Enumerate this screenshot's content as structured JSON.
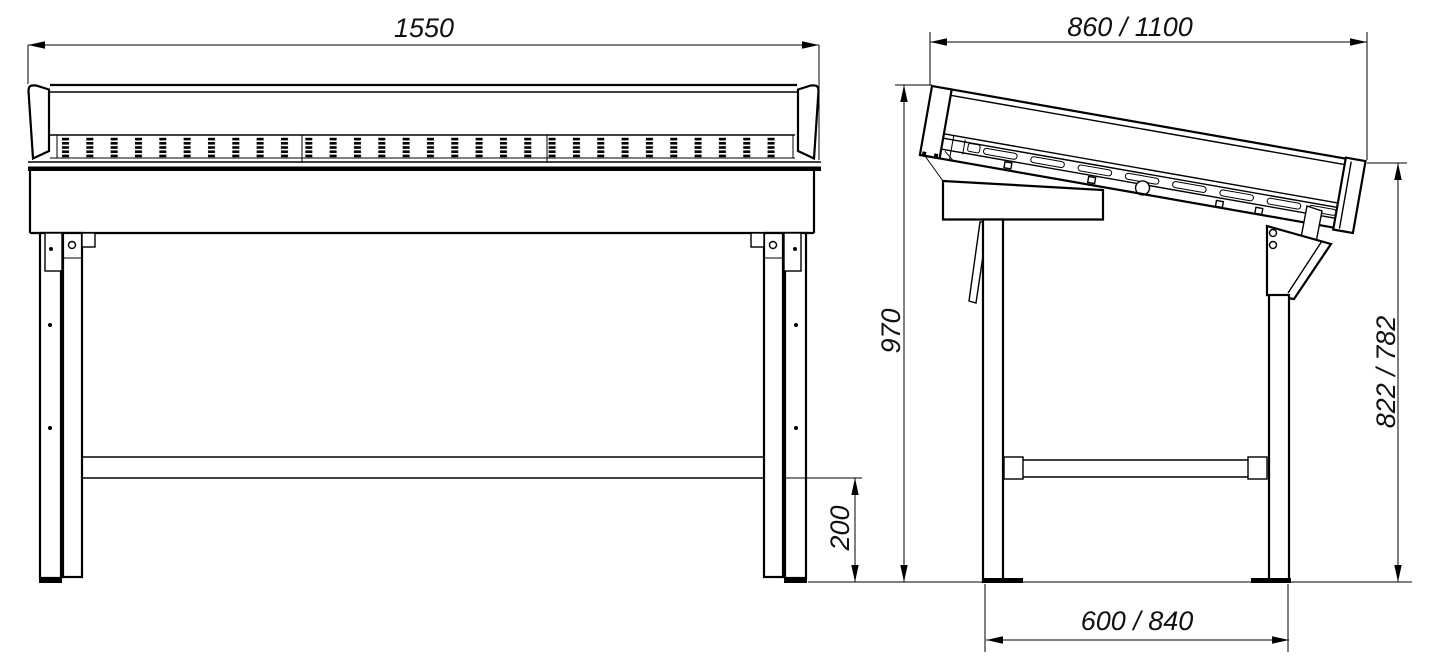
{
  "drawing": {
    "colors": {
      "line": "#000000",
      "background": "#ffffff"
    },
    "dimensions": {
      "overall_width": "1550",
      "depth_top": "860 / 1100",
      "height_back": "970",
      "height_front": "822 / 782",
      "crossbar_to_floor": "200",
      "leg_spread": "600 / 840"
    }
  }
}
